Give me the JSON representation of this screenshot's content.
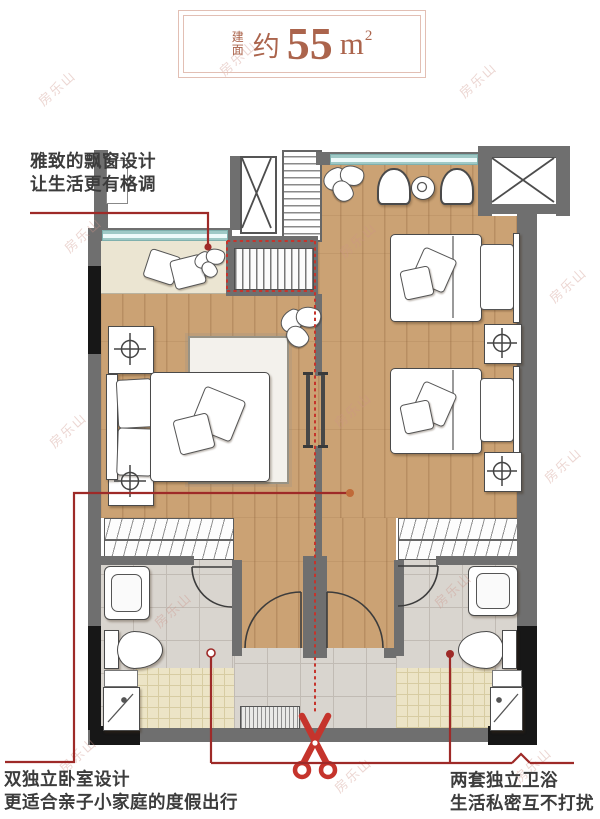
{
  "title": {
    "prefix": "建面",
    "approx": "约",
    "area": "55",
    "unit": "m",
    "unit_sup": "2"
  },
  "annotations": {
    "bay_window": {
      "line1": "雅致的飘窗设计",
      "line2": "让生活更有格调"
    },
    "bedrooms": {
      "line1": "双独立卧室设计",
      "line2": "更适合亲子小家庭的度假出行"
    },
    "bathrooms": {
      "line1": "两套独立卫浴",
      "line2": "生活私密互不打扰"
    }
  },
  "watermark": {
    "text": "房乐山"
  },
  "colors": {
    "annotation_red": "#9e2a28",
    "cut_line_red": "#c5342c",
    "title_brown": "#ab644c",
    "wall_gray": "#6f6f6f",
    "wood_floor": "#cba274",
    "window_teal": "#9fc9c6"
  }
}
